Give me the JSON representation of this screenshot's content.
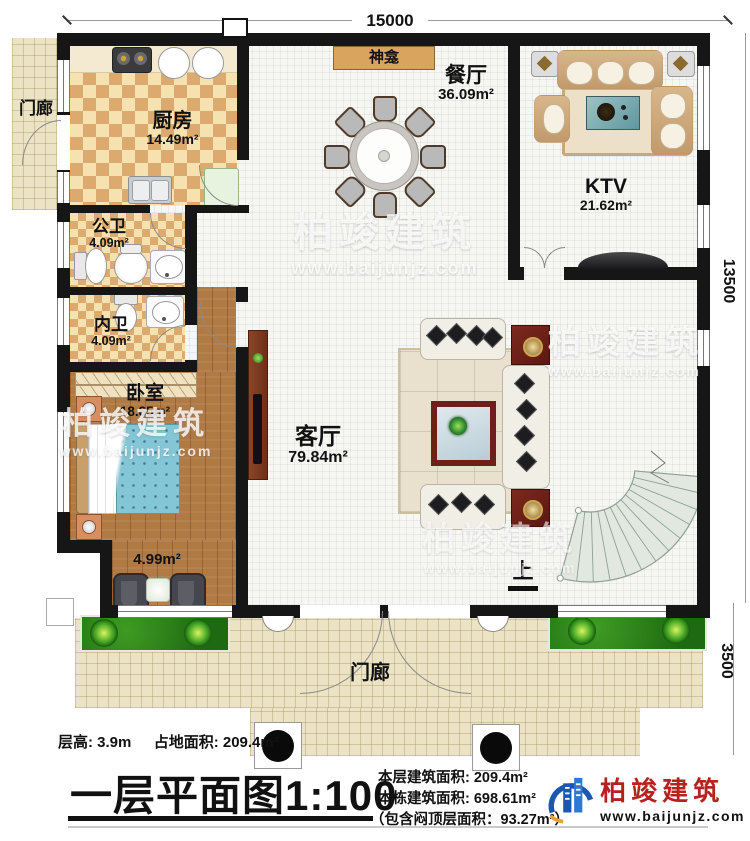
{
  "dimensions": {
    "top": "15000",
    "right": "13500",
    "porch": "3500"
  },
  "rooms": {
    "porch_left": {
      "name": "门廊"
    },
    "kitchen": {
      "name": "厨房",
      "area": "14.49m²"
    },
    "shrine": {
      "name": "神龛"
    },
    "dining": {
      "name": "餐厅",
      "area": "36.09m²"
    },
    "ktv": {
      "name": "KTV",
      "area": "21.62m²"
    },
    "bath_public": {
      "name": "公卫",
      "area": "4.09m²"
    },
    "bath_private": {
      "name": "内卫",
      "area": "4.09m²"
    },
    "bedroom": {
      "name": "卧室",
      "area": "18.85m²"
    },
    "balcony": {
      "area": "4.99m²"
    },
    "living": {
      "name": "客厅",
      "area": "79.84m²"
    },
    "stairs": {
      "up": "上"
    },
    "porch_front": {
      "name": "门廊"
    }
  },
  "footer": {
    "floor_height": "层高: 3.9m",
    "land_area": "占地面积: 209.4m²",
    "title": "一层平面图",
    "scale": "1:100",
    "area_floor": "本层建筑面积: 209.4m²",
    "area_building": "本栋建筑面积: 698.61m²",
    "area_attic": "（包含闷顶层面积：93.27m²）"
  },
  "brand": {
    "name": "柏竣建筑",
    "url": "www.baijunjz.com"
  },
  "watermark": {
    "text": "柏竣建筑",
    "url": "www.baijunjz.com"
  },
  "colors": {
    "wall": "#161616",
    "wood": "#b07a45",
    "checker": "#dcaa6e",
    "tile": "#ebe3c3",
    "accent_red": "#6e1f1a",
    "brand_red": "#b5231f",
    "brand_blue": "#1a57b0",
    "bed_blue": "#84c6d6"
  }
}
